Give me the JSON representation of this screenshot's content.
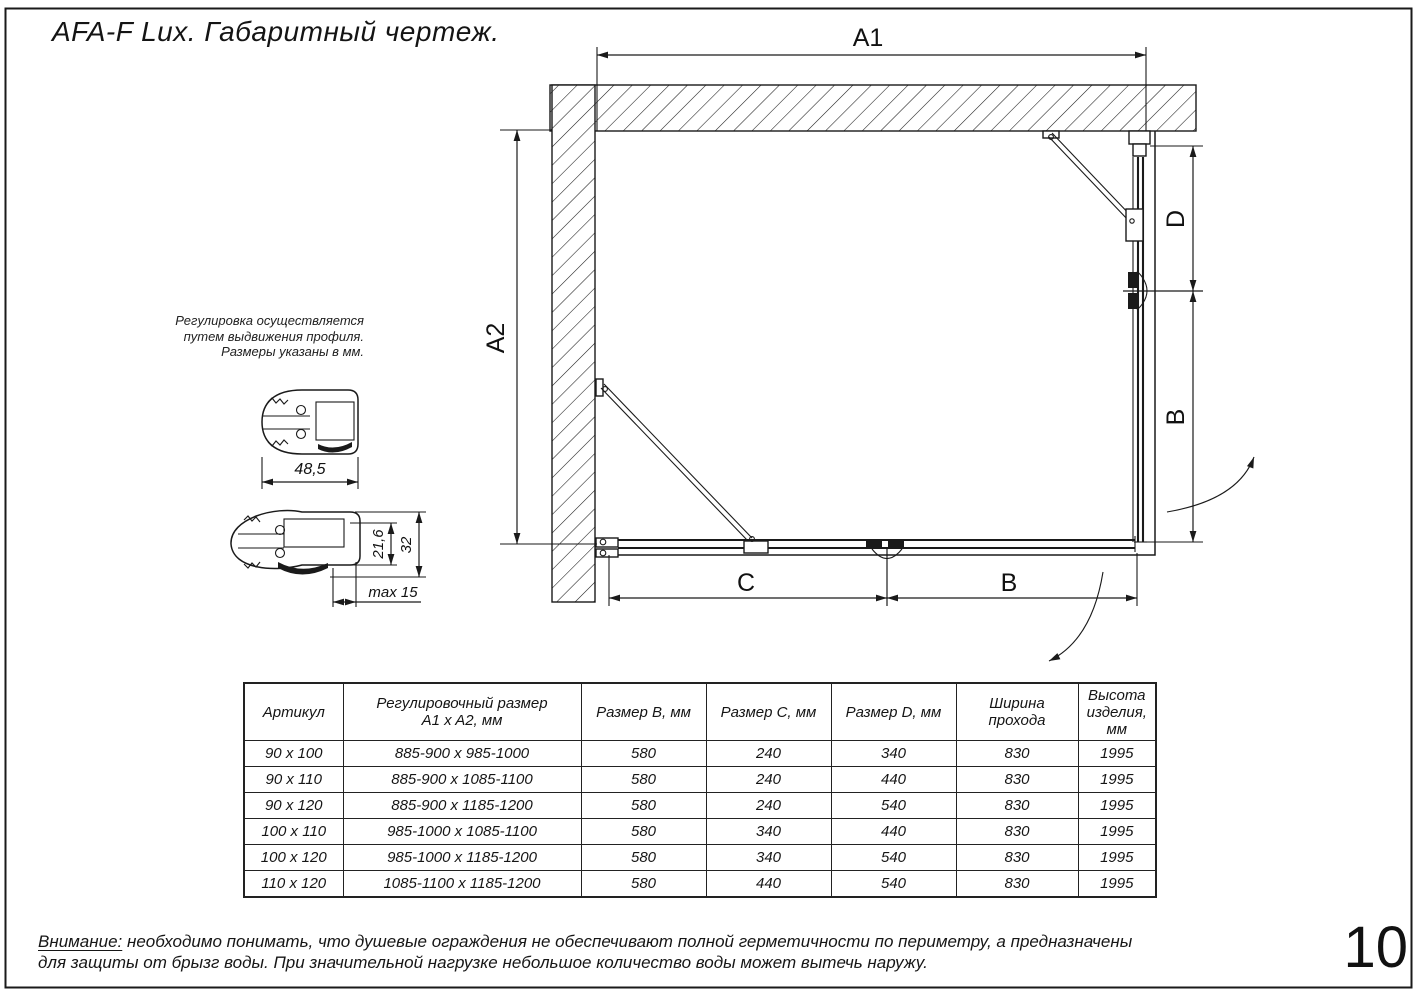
{
  "page": {
    "title": "AFA-F Lux. Габаритный чертеж.",
    "number": "10"
  },
  "note": {
    "line1": "Регулировка осуществляется",
    "line2": "путем выдвижения профиля.",
    "line3": "Размеры указаны в мм."
  },
  "dimensions": {
    "a1": "A1",
    "a2": "A2",
    "d_right": "D",
    "b_right": "B",
    "c_bottom": "C",
    "b_bottom": "B",
    "profile_width": "48,5",
    "profile_inner_height": "21,6",
    "profile_outer_height": "32",
    "profile_max": "max 15"
  },
  "table": {
    "headers": [
      "Артикул",
      "Регулировочный размер\nA1 x A2, мм",
      "Размер B, мм",
      "Размер C, мм",
      "Размер D, мм",
      "Ширина\nпрохода",
      "Высота\nизделия,\nмм"
    ],
    "rows": [
      [
        "90 x 100",
        "885-900 x 985-1000",
        "580",
        "240",
        "340",
        "830",
        "1995"
      ],
      [
        "90 x 110",
        "885-900 x 1085-1100",
        "580",
        "240",
        "440",
        "830",
        "1995"
      ],
      [
        "90 x 120",
        "885-900 x 1185-1200",
        "580",
        "240",
        "540",
        "830",
        "1995"
      ],
      [
        "100 x 110",
        "985-1000 x 1085-1100",
        "580",
        "340",
        "440",
        "830",
        "1995"
      ],
      [
        "100 x 120",
        "985-1000 x 1185-1200",
        "580",
        "340",
        "540",
        "830",
        "1995"
      ],
      [
        "110 x 120",
        "1085-1100 x 1185-1200",
        "580",
        "440",
        "540",
        "830",
        "1995"
      ]
    ]
  },
  "warning": {
    "label": "Внимание:",
    "line1": " необходимо понимать, что душевые ограждения не обеспечивают полной герметичности по периметру, а предназначены",
    "line2": "для защиты от брызг воды. При значительной нагрузке небольшое количество воды может вытечь наружу."
  },
  "colors": {
    "ink": "#1a1a1a",
    "paper": "#ffffff"
  }
}
